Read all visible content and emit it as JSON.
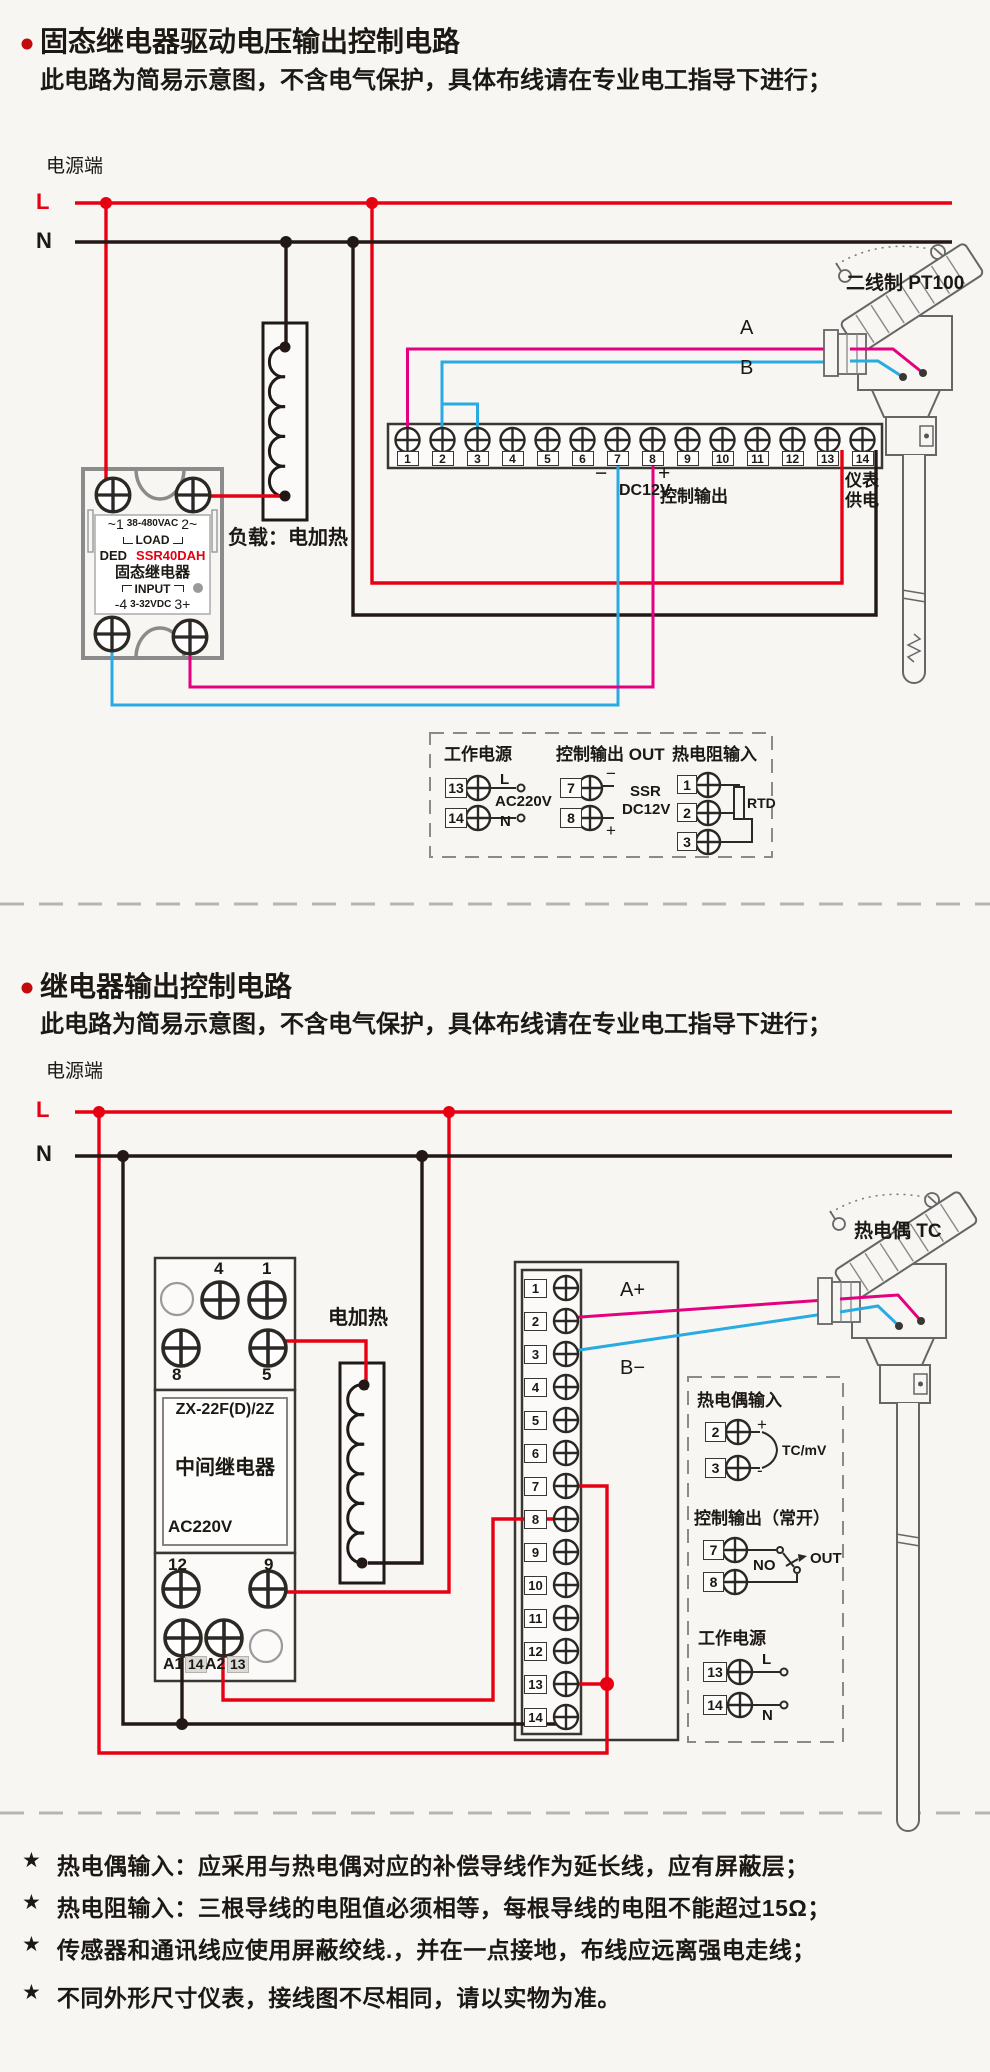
{
  "colors": {
    "background": "#f7f6f3",
    "wire_live_red": "#e60012",
    "wire_neutral_black": "#231815",
    "wire_a_magenta": "#e4007f",
    "wire_b_blue": "#29abe2",
    "model_text_red": "#e60012",
    "bullet_red": "#c40a0a"
  },
  "terminals": [
    "1",
    "2",
    "3",
    "4",
    "5",
    "6",
    "7",
    "8",
    "9",
    "10",
    "11",
    "12",
    "13",
    "14"
  ],
  "section1": {
    "title": "固态继电器驱动电压输出控制电路",
    "subtitle": "此电路为简易示意图，不含电气保护，具体布线请在专业电工指导下进行；",
    "power_label": "电源端",
    "l": "L",
    "n": "N",
    "ssr": {
      "t1": "~1",
      "vac": "38-480VAC",
      "t2": "2~",
      "load": "LOAD",
      "brand": "DED",
      "model": "SSR40DAH",
      "name": "固态继电器",
      "input": "INPUT",
      "t4": "-4",
      "vdc": "3-32VDC",
      "t3": "3+"
    },
    "load_label": "负载：电加热",
    "sensor_label": "二线制 PT100",
    "wire_a": "A",
    "wire_b": "B",
    "minus": "−",
    "plus": "+",
    "dc12v": "DC12V",
    "ctrl_out": "控制输出",
    "meter_line1": "仪表",
    "meter_line2": "供电",
    "legend": {
      "work_title": "工作电源",
      "work_t1": "13",
      "work_t2": "14",
      "work_l": "L",
      "work_mid": "AC220V",
      "work_n": "N",
      "out_title": "控制输出 OUT",
      "out_t1": "7",
      "out_t2": "8",
      "out_minus": "−",
      "out_plus": "+",
      "out_r1": "SSR",
      "out_r2": "DC12V",
      "rtd_title": "热电阻输入",
      "rtd_t1": "1",
      "rtd_t2": "2",
      "rtd_t3": "3",
      "rtd_label": "RTD"
    }
  },
  "section2": {
    "title": "继电器输出控制电路",
    "subtitle": "此电路为简易示意图，不含电气保护，具体布线请在专业电工指导下进行；",
    "power_label": "电源端",
    "l": "L",
    "n": "N",
    "relay": {
      "t4": "4",
      "t1": "1",
      "t8": "8",
      "t5": "5",
      "model": "ZX-22F(D)/2Z",
      "name": "中间继电器",
      "volt": "AC220V",
      "t12": "12",
      "t9": "9",
      "a1": "A1",
      "a1s": "14",
      "a2": "A2",
      "a2s": "13"
    },
    "heater_label": "电加热",
    "sensor_label": "热电偶 TC",
    "wire_a": "A+",
    "wire_b": "B−",
    "legend": {
      "tc_title": "热电偶输入",
      "tc_t1": "2",
      "tc_t2": "3",
      "tc_plus": "+",
      "tc_minus": "-",
      "tc_label": "TC/mV",
      "out_title": "控制输出（常开）",
      "out_t1": "7",
      "out_t2": "8",
      "out_no": "NO",
      "out_label": "OUT",
      "work_title": "工作电源",
      "work_t1": "13",
      "work_t2": "14",
      "work_l": "L",
      "work_n": "N"
    }
  },
  "note_star": "★",
  "notes": [
    "热电偶输入：应采用与热电偶对应的补偿导线作为延长线，应有屏蔽层；",
    "热电阻输入：三根导线的电阻值必须相等，每根导线的电阻不能超过15Ω；",
    "传感器和通讯线应使用屏蔽绞线.，并在一点接地，布线应远离强电走线；",
    "不同外形尺寸仪表，接线图不尽相同，请以实物为准。"
  ]
}
